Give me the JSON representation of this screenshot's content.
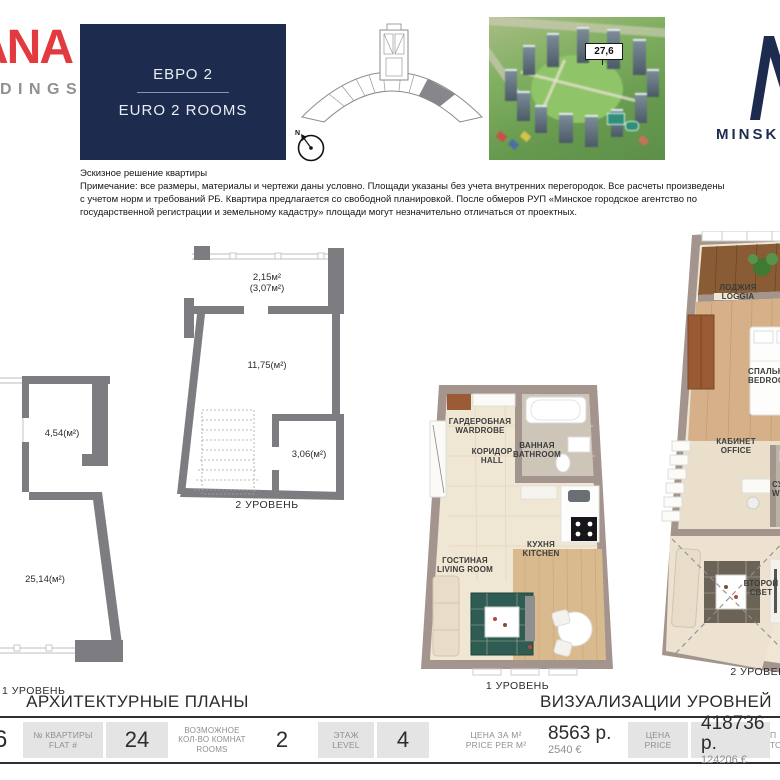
{
  "colors": {
    "navy": "#1d2c4e",
    "brand_red": "#e13b3f",
    "chip_gray": "#e4e4e4",
    "wall_gray": "#7d7d81",
    "highlight_unit_gray": "#87878b"
  },
  "header": {
    "brand_top": "ANA",
    "brand_bottom": "DINGS",
    "unit_type_ru": "ЕВРО 2",
    "unit_type_en": "EURO 2 ROOMS",
    "compass": "N",
    "tower_marker": "27,6",
    "right_brand_text": "MINSK W"
  },
  "disclaimer": {
    "title": "Эскизное решение квартиры",
    "lines": [
      "Примечание: все размеры, материалы и чертежи даны условно. Площади указаны без учета внутренних перегородок. Все расчеты произведены",
      "с учетом норм и требований РБ. Квартира предлагается со свободной планировкой. После обмеров РУП «Минское городское агентство по",
      "государственной регистрации и земельному кадастру» площади могут незначительно отличаться от проектных."
    ]
  },
  "plans": {
    "section_title": "АРХИТЕКТУРНЫЕ ПЛАНЫ",
    "level1": {
      "caption": "1 УРОВЕНЬ",
      "area_room1": "4,54(м²)",
      "area_room2": "25,14(м²)"
    },
    "level2": {
      "caption": "2 УРОВЕНЬ",
      "area_balcony": "2,15м²",
      "area_balcony_full": "(3,07м²)",
      "area_room": "11,75(м²)",
      "area_room2": "3,06(м²)"
    }
  },
  "visualizations": {
    "section_title": "ВИЗУАЛИЗАЦИИ УРОВНЕЙ",
    "level1": {
      "caption": "1 УРОВЕНЬ",
      "wardrobe_ru": "ГАРДЕРОБНАЯ",
      "wardrobe_en": "WARDROBE",
      "hall_ru": "КОРИДОР",
      "hall_en": "HALL",
      "bathroom_ru": "ВАННАЯ",
      "bathroom_en": "BATHROOM",
      "kitchen_ru": "КУХНЯ",
      "kitchen_en": "KITCHEN",
      "living_ru": "ГОСТИНАЯ",
      "living_en": "LIVING ROOM"
    },
    "level2": {
      "caption": "2 УРОВЕНЬ",
      "loggia_ru": "ЛОДЖИЯ",
      "loggia_en": "LOGGIA",
      "bedroom_ru": "СПАЛЬНЯ",
      "bedroom_en": "BEDROOM",
      "office_ru": "КАБИНЕТ",
      "office_en": "OFFICE",
      "wc_ru": "СУ",
      "wc_en": "WC",
      "secondlight_ru": "ВТОРОЙ",
      "secondlight_en": "СВЕТ"
    }
  },
  "table": {
    "edge_value": "6",
    "flat_label_ru": "№ КВАРТИРЫ",
    "flat_label_en": "FLAT #",
    "flat_value": "24",
    "rooms_label_1": "ВОЗМОЖНОЕ",
    "rooms_label_2": "КОЛ-ВО КОМНАТ",
    "rooms_label_3": "ROOMS",
    "rooms_value": "2",
    "level_label_ru": "ЭТАЖ",
    "level_label_en": "LEVEL",
    "level_value": "4",
    "ppm_label_ru": "ЦЕНА ЗА М²",
    "ppm_label_en": "PRICE PER M²",
    "ppm_value_byn": "8563 р.",
    "ppm_value_eur": "2540 €",
    "price_label_ru": "ЦЕНА",
    "price_label_en": "PRICE",
    "price_value_byn": "418736 р.",
    "price_value_eur": "124206 €",
    "cut_label_ru": "П",
    "cut_label_en": "ТО"
  }
}
